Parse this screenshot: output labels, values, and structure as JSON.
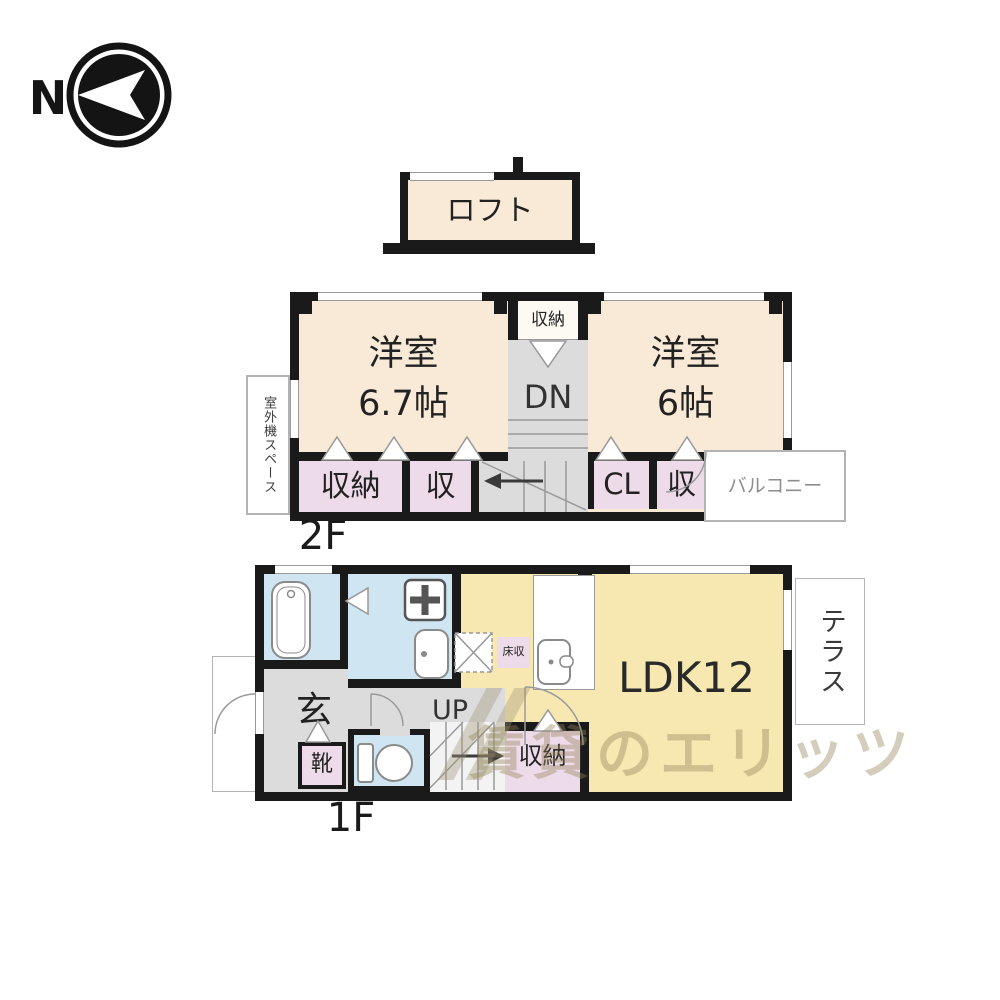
{
  "compass": {
    "label": "N"
  },
  "loft": {
    "label": "ロフト"
  },
  "f2": {
    "floor_label": "2F",
    "west_room": {
      "name": "洋室",
      "size": "6.7帖"
    },
    "east_room": {
      "name": "洋室",
      "size": "6帖"
    },
    "closet_top": "収納",
    "stairs_down": "DN",
    "closet_a": "収納",
    "closet_b": "収",
    "closet_cl": "CL",
    "closet_c": "収",
    "balcony": "バルコニー",
    "outdoor_unit_space": "室外機スペース"
  },
  "f1": {
    "floor_label": "1F",
    "ldk": "LDK12",
    "entrance": "玄",
    "shoes": "靴",
    "stairs_up": "UP",
    "closet": "収納",
    "floor_storage": "床収",
    "terrace": "テラス"
  },
  "watermark": "賃貸のエリッツ",
  "colors": {
    "wall": "#1a1a1a",
    "room_cream": "#f8ead6",
    "ldk_yellow": "#f7e8b2",
    "closet_pink": "#eedbe9",
    "water_blue": "#cfe6f2",
    "hall_gray": "#dcdcdc",
    "outline_gray": "#b3b3b3",
    "watermark_tan": "#948358"
  }
}
